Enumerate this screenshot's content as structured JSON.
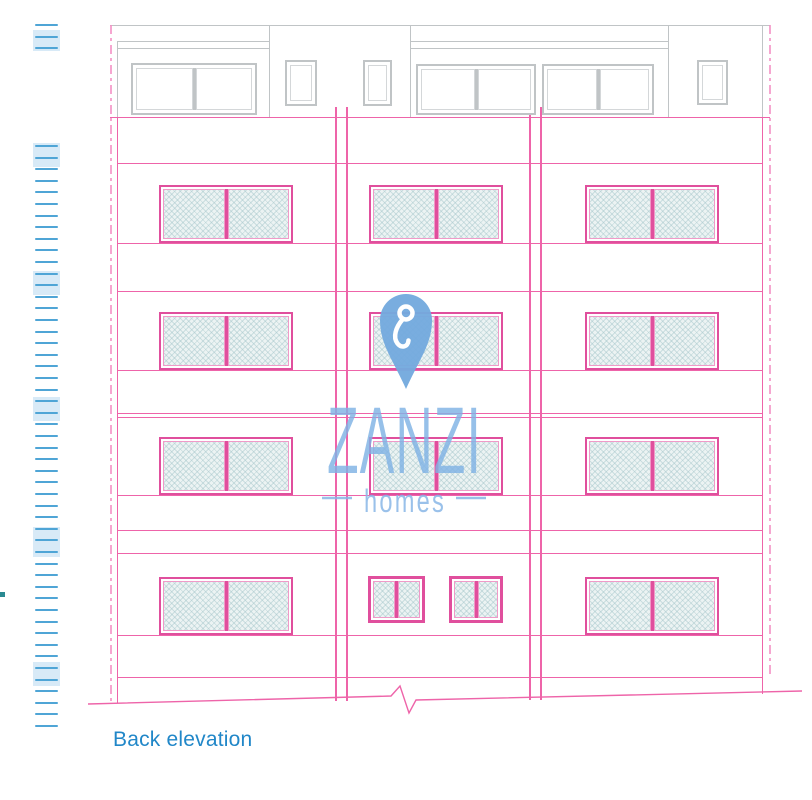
{
  "caption": {
    "text": "Back elevation"
  },
  "logo": {
    "brand": "ZANZI",
    "tagline": "homes",
    "pin_icon": "location-pin-icon",
    "pin_color": "#74aade",
    "brand_color": "#7fb2e4",
    "tagline_color": "#88b6e6"
  },
  "drawing_title": "Back elevation of four-storey apartment block with roof level",
  "colors": {
    "pink_line": "#ee64a9",
    "pink_light": "#f490c4",
    "window_frame": "#e04f9d",
    "gray_line": "#c0c4c6",
    "tick_blue": "#4fa5d6",
    "tick_fill": "#d8eaf7",
    "caption_blue": "#2187c8",
    "hatch_fill": "#ecf3f3"
  },
  "geometry": {
    "canvas": {
      "w": 812,
      "h": 800
    },
    "hlines_pink": [
      {
        "y": 117,
        "x1": 110,
        "x2": 770
      },
      {
        "y": 163,
        "x1": 117,
        "x2": 762
      },
      {
        "y": 243,
        "x1": 117,
        "x2": 762
      },
      {
        "y": 291,
        "x1": 117,
        "x2": 762
      },
      {
        "y": 370,
        "x1": 117,
        "x2": 762
      },
      {
        "y": 413,
        "x1": 117,
        "x2": 762
      },
      {
        "y": 417,
        "x1": 117,
        "x2": 762
      },
      {
        "y": 495,
        "x1": 117,
        "x2": 762
      },
      {
        "y": 530,
        "x1": 117,
        "x2": 762
      },
      {
        "y": 553,
        "x1": 117,
        "x2": 762
      },
      {
        "y": 635,
        "x1": 117,
        "x2": 762
      },
      {
        "y": 677,
        "x1": 117,
        "x2": 762
      }
    ],
    "hlines_gray": [
      {
        "y": 25,
        "x1": 110,
        "x2": 770
      },
      {
        "y": 41,
        "x1": 117,
        "x2": 269
      },
      {
        "y": 48,
        "x1": 117,
        "x2": 269
      },
      {
        "y": 41,
        "x1": 410,
        "x2": 668
      },
      {
        "y": 48,
        "x1": 410,
        "x2": 668
      }
    ],
    "vlines_pink": [
      {
        "x": 117,
        "y1": 117,
        "y2": 703
      },
      {
        "x": 762,
        "y1": 117,
        "y2": 694
      }
    ],
    "vlines_gray": [
      {
        "x": 117,
        "y1": 41,
        "y2": 117
      },
      {
        "x": 269,
        "y1": 25,
        "y2": 117
      },
      {
        "x": 410,
        "y1": 25,
        "y2": 117
      },
      {
        "x": 668,
        "y1": 25,
        "y2": 117
      },
      {
        "x": 762,
        "y1": 25,
        "y2": 117
      }
    ],
    "centerlines": [
      {
        "x": 110,
        "y1": 25,
        "y2": 704
      },
      {
        "x": 769,
        "y1": 25,
        "y2": 677
      }
    ],
    "pilasters": [
      {
        "x": 335,
        "y1": 107,
        "y2": 701,
        "w": 9
      },
      {
        "x": 529,
        "y1": 107,
        "y2": 700,
        "w": 9
      }
    ],
    "roof_windows": [
      {
        "x": 131,
        "y": 63,
        "w": 126,
        "h": 52,
        "panes": 2
      },
      {
        "x": 285,
        "y": 60,
        "w": 32,
        "h": 46,
        "panes": 1
      },
      {
        "x": 363,
        "y": 60,
        "w": 29,
        "h": 46,
        "panes": 1
      },
      {
        "x": 416,
        "y": 64,
        "w": 120,
        "h": 51,
        "panes": 2
      },
      {
        "x": 542,
        "y": 64,
        "w": 112,
        "h": 51,
        "panes": 2
      },
      {
        "x": 697,
        "y": 60,
        "w": 31,
        "h": 45,
        "panes": 1
      }
    ],
    "balcony_rows": [
      185,
      312,
      437
    ],
    "balcony_cols": [
      159,
      369,
      585
    ],
    "balcony_w": 134,
    "balcony_h": 58,
    "ground_row": {
      "y": 577,
      "h": 58,
      "cols": [
        159,
        585
      ],
      "smalls": [
        {
          "x": 368,
          "y": 576,
          "w": 57,
          "h": 47
        },
        {
          "x": 449,
          "y": 576,
          "w": 54,
          "h": 47
        }
      ]
    },
    "ticks": {
      "x": 35,
      "w": 23,
      "top_group": [
        24,
        36,
        47
      ],
      "top_fill": {
        "x": 33,
        "y": 30,
        "w": 27,
        "h": 21
      },
      "main": {
        "y1": 145,
        "step": 11.6,
        "count": 51
      },
      "fills": [
        {
          "x": 33,
          "y": 143,
          "w": 27,
          "h": 24
        },
        {
          "x": 33,
          "y": 271,
          "w": 27,
          "h": 24
        },
        {
          "x": 33,
          "y": 397,
          "w": 27,
          "h": 24
        },
        {
          "x": 33,
          "y": 527,
          "w": 27,
          "h": 30
        },
        {
          "x": 33,
          "y": 662,
          "w": 27,
          "h": 24
        }
      ],
      "marker_dot": {
        "x": 0,
        "y": 592,
        "w": 5,
        "h": 5
      }
    },
    "ground_path": "M88,704 L391,696 L400,686 L409,713 L416,700 L802,691",
    "pin": {
      "x": 378,
      "y": 292,
      "w": 56,
      "h": 99
    },
    "brand_text": {
      "x": 327,
      "y": 473,
      "size": 95,
      "length": 155
    },
    "tagline_text": {
      "x": 364,
      "y": 512,
      "size": 32,
      "length": 82
    },
    "tagline_dashes": [
      {
        "x1": 322,
        "x2": 352,
        "y": 498
      },
      {
        "x1": 456,
        "x2": 486,
        "y": 498
      }
    ]
  }
}
